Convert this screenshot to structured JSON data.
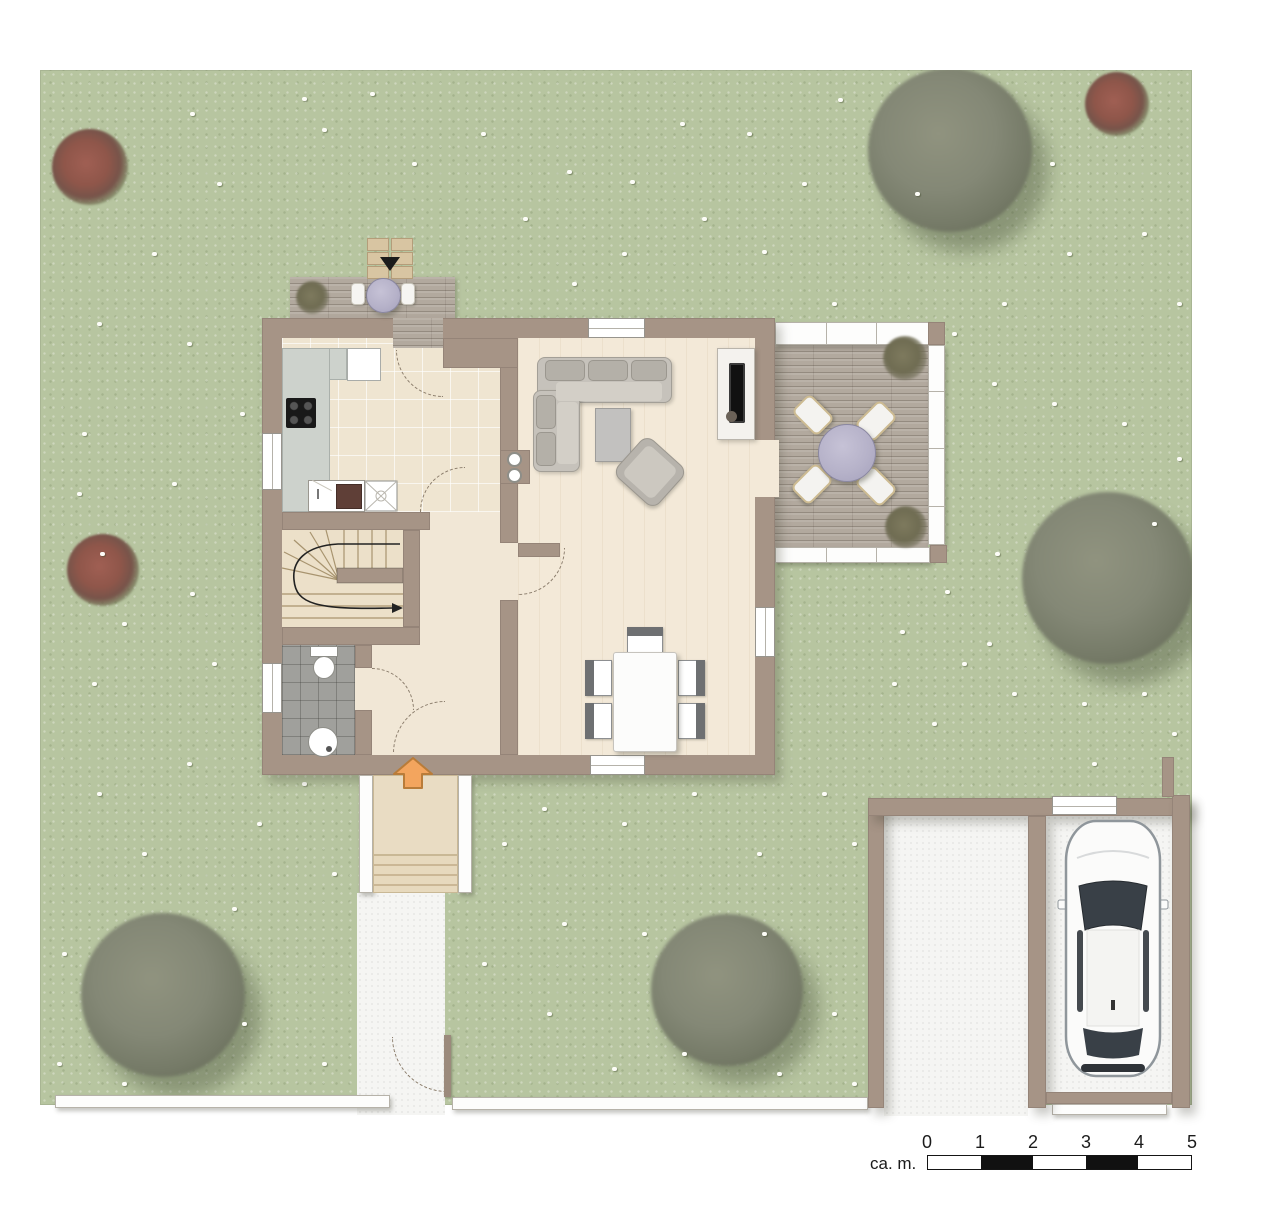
{
  "scale_bar": {
    "label": "ca. m.",
    "ticks": [
      "0",
      "1",
      "2",
      "3",
      "4",
      "5"
    ],
    "segments": [
      "#ffffff",
      "#111111",
      "#ffffff",
      "#111111",
      "#ffffff"
    ]
  },
  "palette": {
    "garden_green": "#b7c5a0",
    "wall_taupe": "#a69486",
    "wood_floor": "#f3e9d8",
    "kitchen_tile": "#efe5d1",
    "bath_tile": "#a0a09c",
    "deck_wood": "#b2a99e",
    "concrete_white": "#f5f5f3",
    "counter_gray": "#cdd2cc",
    "table_lavender": "#b6b2c9",
    "entry_arrow_orange": "#f3a55e",
    "fence_white": "#fdfdfc",
    "tree_gray_green": "#7e8271",
    "shrub_red": "#96584e",
    "car_white": "#fbfbfa"
  },
  "scene": {
    "rooms": [
      "kitchen",
      "hallway",
      "winder-stairs",
      "wc-bathroom",
      "living-dining-room",
      "terrace",
      "roof-deck",
      "entrance-steps",
      "garage",
      "driveway",
      "garden"
    ],
    "furniture": [
      "corner-sofa",
      "coffee-table",
      "armchair",
      "tv-sideboard",
      "dining-table",
      "dining-chairs",
      "terrace-table",
      "terrace-chairs",
      "deck-table",
      "kitchen-counter",
      "cooktop",
      "sink",
      "toilet",
      "washbasin",
      "car"
    ],
    "trees": [
      {
        "x": 910,
        "y": 80,
        "r": 82
      },
      {
        "x": 1068,
        "y": 508,
        "r": 86
      },
      {
        "x": 123,
        "y": 925,
        "r": 82
      },
      {
        "x": 687,
        "y": 920,
        "r": 76
      }
    ],
    "red_bushes": [
      {
        "x": 50,
        "y": 97,
        "r": 38
      },
      {
        "x": 1077,
        "y": 34,
        "r": 32
      },
      {
        "x": 63,
        "y": 500,
        "r": 36
      }
    ],
    "flowers": [
      [
        282,
        58
      ],
      [
        372,
        92
      ],
      [
        590,
        110
      ],
      [
        707,
        62
      ],
      [
        762,
        112
      ],
      [
        798,
        28
      ],
      [
        722,
        180
      ],
      [
        662,
        147
      ],
      [
        527,
        100
      ],
      [
        441,
        62
      ],
      [
        262,
        27
      ],
      [
        177,
        112
      ],
      [
        112,
        182
      ],
      [
        57,
        252
      ],
      [
        147,
        272
      ],
      [
        42,
        362
      ],
      [
        132,
        412
      ],
      [
        37,
        422
      ],
      [
        82,
        552
      ],
      [
        52,
        612
      ],
      [
        172,
        592
      ],
      [
        147,
        692
      ],
      [
        57,
        722
      ],
      [
        102,
        782
      ],
      [
        217,
        752
      ],
      [
        262,
        712
      ],
      [
        192,
        837
      ],
      [
        292,
        802
      ],
      [
        462,
        772
      ],
      [
        502,
        737
      ],
      [
        582,
        752
      ],
      [
        652,
        722
      ],
      [
        717,
        782
      ],
      [
        782,
        722
      ],
      [
        812,
        772
      ],
      [
        892,
        652
      ],
      [
        852,
        612
      ],
      [
        922,
        592
      ],
      [
        972,
        622
      ],
      [
        1042,
        632
      ],
      [
        1102,
        622
      ],
      [
        1132,
        662
      ],
      [
        1052,
        692
      ],
      [
        947,
        572
      ],
      [
        1137,
        387
      ],
      [
        1082,
        352
      ],
      [
        1012,
        332
      ],
      [
        952,
        312
      ],
      [
        912,
        262
      ],
      [
        962,
        232
      ],
      [
        1027,
        182
      ],
      [
        1102,
        162
      ],
      [
        1137,
        232
      ],
      [
        792,
        232
      ],
      [
        582,
        182
      ],
      [
        483,
        147
      ],
      [
        150,
        522
      ],
      [
        60,
        482
      ],
      [
        442,
        892
      ],
      [
        507,
        942
      ],
      [
        572,
        997
      ],
      [
        642,
        982
      ],
      [
        737,
        1002
      ],
      [
        792,
        942
      ],
      [
        812,
        1012
      ],
      [
        602,
        862
      ],
      [
        522,
        852
      ],
      [
        722,
        862
      ],
      [
        202,
        952
      ],
      [
        22,
        882
      ],
      [
        17,
        992
      ],
      [
        282,
        992
      ],
      [
        82,
        1012
      ],
      [
        1112,
        452
      ],
      [
        860,
        560
      ],
      [
        532,
        212
      ],
      [
        200,
        342
      ],
      [
        905,
        520
      ],
      [
        955,
        482
      ],
      [
        640,
        52
      ],
      [
        875,
        122
      ],
      [
        1010,
        92
      ],
      [
        330,
        22
      ],
      [
        150,
        42
      ]
    ]
  }
}
